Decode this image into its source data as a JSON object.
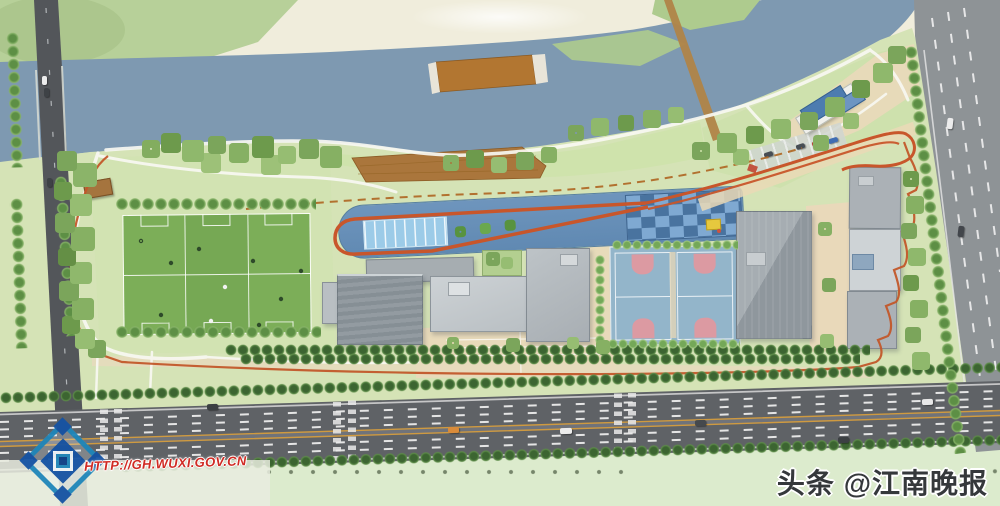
{
  "watermarks": {
    "planning_url": "HTTP://GH.WUXI.GOV.CN",
    "toutiao_badge": "头条",
    "publisher_handle": "@江南晚报",
    "logo": "wuxi-planning-bureau-logo"
  },
  "site_features": {
    "soccer_fields": 3,
    "basketball_courts": 2,
    "swimming_pool": 1,
    "running_track_loop": 1
  },
  "palette": {
    "river": "#7e99b1",
    "site_green": "#d5e3b6",
    "field_green": "#7cae58",
    "track_orange": "#c8562b",
    "sports_strip_blue": "#6b93bb",
    "pool_blue": "#9ccbe8",
    "court_blue": "#93b5ca",
    "court_key_pink": "#dc9aa2",
    "building_gray": "#9aa1a6",
    "plaza_tan": "#e9d9ba",
    "road_dark": "#53565a",
    "highway_gray": "#5f6266",
    "boardwalk_brown": "#aa763c"
  }
}
